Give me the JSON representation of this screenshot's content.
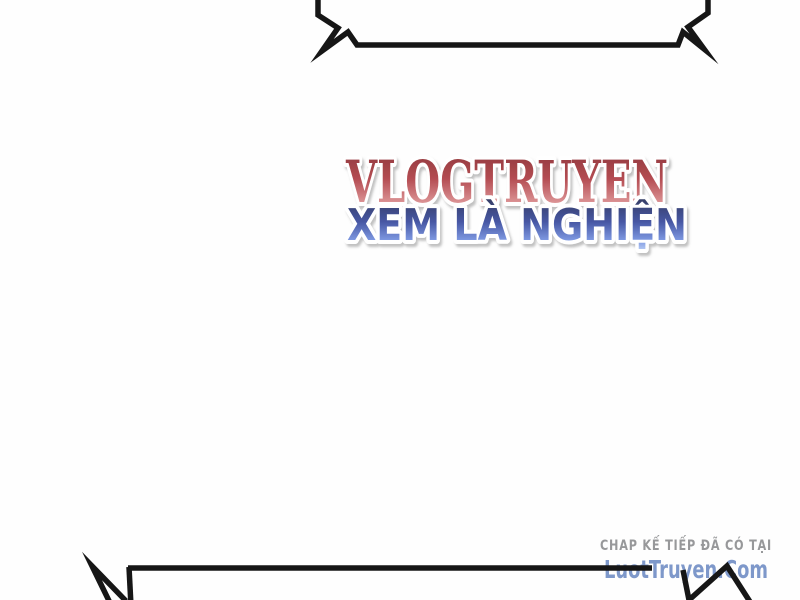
{
  "canvas": {
    "background": "#fefefe"
  },
  "speech_bubbles": {
    "stroke_color": "#161616",
    "top_bubble": "jagged shout bubble, cropped at top edge of page",
    "bottom_bubble": "jagged shout bubble, cropped at bottom edge of page"
  },
  "watermark": {
    "title": "VLOGTRUYEN",
    "subtitle": "XEM LÀ NGHIỆN",
    "outline_color": "#ffffff",
    "title_color_top": "#8c373b",
    "title_color_mid": "#b44c52",
    "title_color_low": "#d98e90",
    "title_color_bottom": "#f3d8d6",
    "subtitle_color_top": "#353d63",
    "subtitle_color_mid": "#4757a4",
    "subtitle_color_low": "#7e99e2",
    "subtitle_color_bottom": "#bdd0f5"
  },
  "footer": {
    "note": "CHAP KẾ TIẾP ĐÃ CÓ TẠI",
    "note_color": "#97989a",
    "site": "LuotTruyen.Com",
    "site_color": "#7e98ca"
  }
}
